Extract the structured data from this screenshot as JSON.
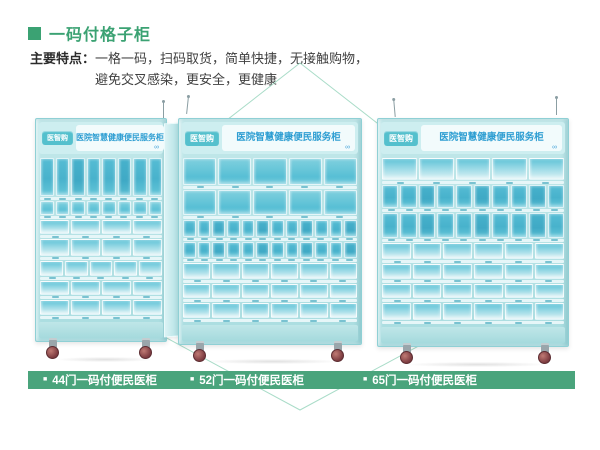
{
  "page": {
    "title": "一码付格子柜"
  },
  "features": {
    "label": "主要特点：",
    "line1": "一格一码，扫码取货，简单快捷，无接触购物，",
    "line2": "避免交叉感染，更安全，更健康"
  },
  "icons": {
    "title_marker": "green-square",
    "label_bullet": "■",
    "brand_logo_glyph": "∞"
  },
  "colors": {
    "accent_green": "#3ba273",
    "bar_green": "#4aa47c",
    "cabinet_teal": "#aadde0",
    "cell_teal": "#58bfd5",
    "badge_teal": "#54c0cd",
    "header_title_blue": "#2e9ed2",
    "deco_line": "#a9dcc8"
  },
  "cabinets": [
    {
      "badge": "医智购",
      "title": "医院智慧健康便民服务柜",
      "label": "44门一码付便民医柜",
      "rows": [
        {
          "cols": 8,
          "h": 42,
          "tone": "dark"
        },
        {
          "cols": 8,
          "h": 15,
          "tone": "medium"
        },
        {
          "cols": 4,
          "h": 16,
          "tone": "light"
        },
        {
          "cols": 4,
          "h": 18,
          "tone": "light"
        },
        {
          "cols": 5,
          "h": 17,
          "tone": "light"
        },
        {
          "cols": 4,
          "h": 15,
          "tone": "light"
        },
        {
          "cols": 4,
          "h": 17,
          "tone": "light"
        }
      ]
    },
    {
      "badge": "医智购",
      "title": "医院智慧健康便民服务柜",
      "label": "52门一码付便民医柜",
      "rows": [
        {
          "cols": 5,
          "h": 33,
          "tone": "medium"
        },
        {
          "cols": 5,
          "h": 31,
          "tone": "medium"
        },
        {
          "cols": 12,
          "h": 21,
          "tone": "dark"
        },
        {
          "cols": 12,
          "h": 20,
          "tone": "dark"
        },
        {
          "cols": 6,
          "h": 20,
          "tone": "light"
        },
        {
          "cols": 6,
          "h": 18,
          "tone": "light"
        },
        {
          "cols": 6,
          "h": 18,
          "tone": "light"
        }
      ]
    },
    {
      "badge": "医智购",
      "title": "医院智慧健康便民服务柜",
      "label": "65门一码付便民医柜",
      "rows": [
        {
          "cols": 5,
          "h": 28,
          "tone": "light"
        },
        {
          "cols": 10,
          "h": 28,
          "tone": "dark"
        },
        {
          "cols": 10,
          "h": 31,
          "tone": "dark"
        },
        {
          "cols": 6,
          "h": 21,
          "tone": "light"
        },
        {
          "cols": 6,
          "h": 18,
          "tone": "light"
        },
        {
          "cols": 6,
          "h": 18,
          "tone": "light"
        },
        {
          "cols": 6,
          "h": 21,
          "tone": "light"
        }
      ]
    }
  ]
}
